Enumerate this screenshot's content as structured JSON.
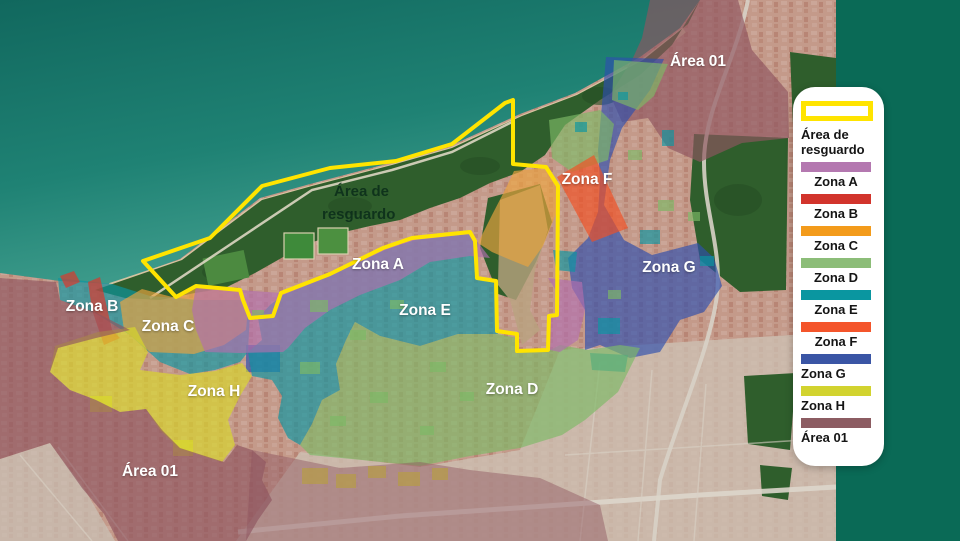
{
  "page": {
    "background_color": "#0a6a56",
    "type_label": "zoning map over satellite imagery"
  },
  "legend": {
    "resguardo": {
      "label": "Área de resguardo",
      "border_color": "#ffe400",
      "fill": "#ffffff"
    },
    "items": [
      {
        "label": "Zona A",
        "color": "#b478b0"
      },
      {
        "label": "Zona B",
        "color": "#d2342c"
      },
      {
        "label": "Zona C",
        "color": "#f39b1b"
      },
      {
        "label": "Zona D",
        "color": "#8cbd78"
      },
      {
        "label": "Zona E",
        "color": "#0a96a0"
      },
      {
        "label": "Zona F",
        "color": "#f4552b"
      },
      {
        "label": "Zona G",
        "color": "#3a55a5"
      },
      {
        "label": "Zona H",
        "color": "#d2d32f"
      },
      {
        "label": "Área 01",
        "color": "#8c5c62"
      }
    ]
  },
  "map": {
    "outline_color": "#ffe400",
    "water_top": "#11685e",
    "water_shore": "#47a392",
    "zone_colors": {
      "zona_a": "#b26fae",
      "zona_b": "#e43327",
      "zona_c": "#eda43e",
      "zona_d": "#7cb966",
      "zona_e": "#0b96a2",
      "zona_f": "#f34f22",
      "zona_g": "#2e4fae",
      "zona_h": "#d9d929",
      "area_01": "#8e5560"
    },
    "labels": {
      "area01_top": "Área 01",
      "zona_f": "Zona F",
      "zona_g": "Zona G",
      "zona_a": "Zona A",
      "zona_e": "Zona E",
      "zona_d": "Zona D",
      "zona_b": "Zona B",
      "zona_c": "Zona C",
      "zona_h": "Zona H",
      "area01_bottom": "Área 01",
      "resguardo_line1": "Área de",
      "resguardo_line2": "resguardo"
    }
  }
}
